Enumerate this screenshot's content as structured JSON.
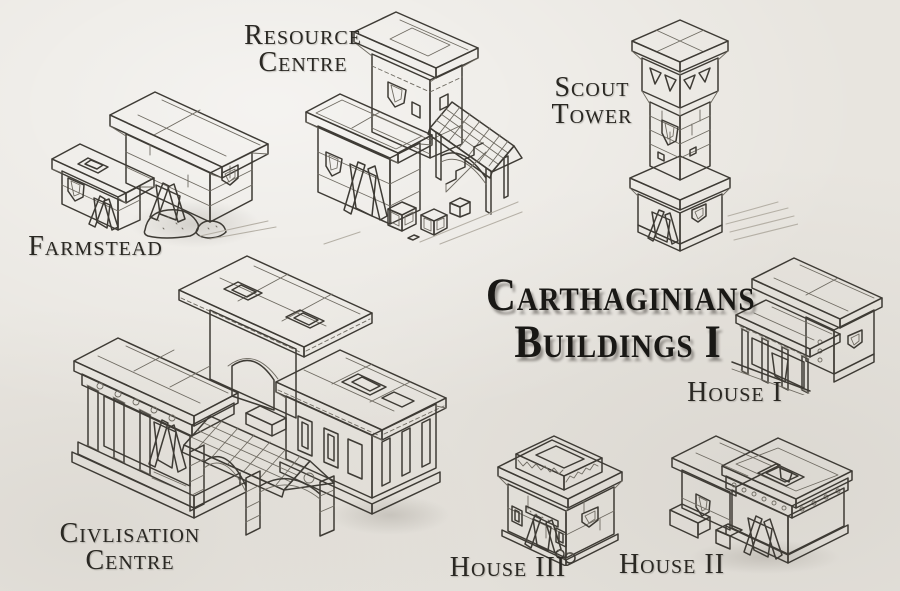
{
  "sheet": {
    "title": {
      "line1": "Carthaginians",
      "line2": "Buildings I"
    },
    "colors": {
      "paper": "#e8e5df",
      "ink": "#3e3b35",
      "title_ink": "#191815",
      "door_shade": "#403d36"
    },
    "sketches": [
      {
        "id": "farmstead",
        "icon": "farmstead-sketch",
        "label_lines": [
          "Farmstead"
        ]
      },
      {
        "id": "resource-centre",
        "icon": "resource-centre-sketch",
        "label_lines": [
          "Resource",
          "Centre"
        ]
      },
      {
        "id": "scout-tower",
        "icon": "scout-tower-sketch",
        "label_lines": [
          "Scout",
          "Tower"
        ]
      },
      {
        "id": "civilisation-centre",
        "icon": "civilisation-centre-sketch",
        "label_lines": [
          "Civlisation",
          "Centre"
        ]
      },
      {
        "id": "house-i",
        "icon": "house-i-sketch",
        "label_lines": [
          "House I"
        ]
      },
      {
        "id": "house-ii",
        "icon": "house-ii-sketch",
        "label_lines": [
          "House II"
        ]
      },
      {
        "id": "house-iii",
        "icon": "house-iii-sketch",
        "label_lines": [
          "House III"
        ]
      }
    ]
  }
}
